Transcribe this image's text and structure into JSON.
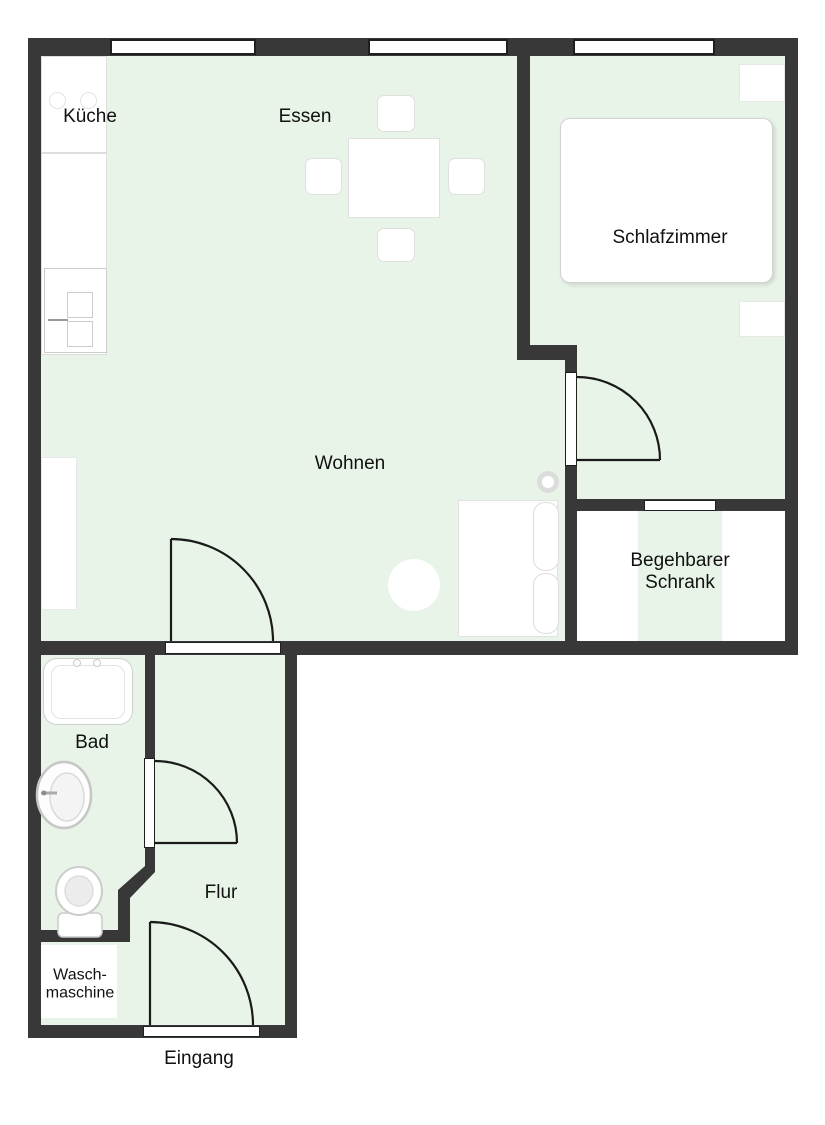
{
  "diagram_type": "apartment-floor-plan",
  "colors": {
    "wall": "#383838",
    "floor": "#e8f4e8",
    "fixture_border": "#cccccc"
  },
  "rooms": {
    "kueche": {
      "label": "Küche"
    },
    "essen": {
      "label": "Essen"
    },
    "schlafzimmer": {
      "label": "Schlafzimmer"
    },
    "wohnen": {
      "label": "Wohnen"
    },
    "begehbarer_schrank": {
      "line1": "Begehbarer",
      "line2": "Schrank"
    },
    "bad": {
      "label": "Bad"
    },
    "flur": {
      "label": "Flur"
    },
    "waschmaschine": {
      "line1": "Wasch-",
      "line2": "maschine"
    },
    "eingang": {
      "label": "Eingang"
    }
  }
}
